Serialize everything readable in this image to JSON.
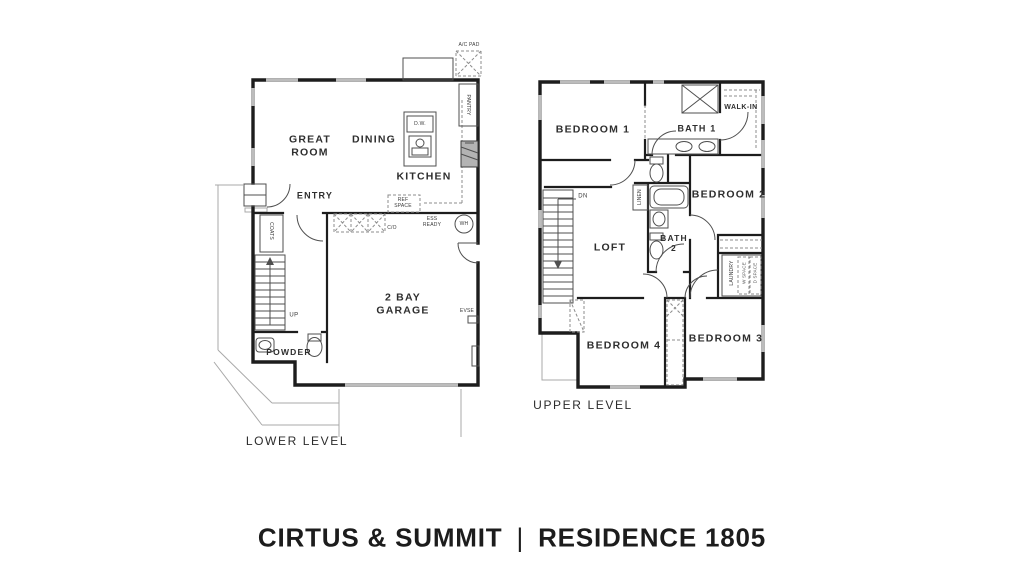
{
  "title": {
    "left": "CIRTUS & SUMMIT",
    "divider": "|",
    "right": "RESIDENCE 1805"
  },
  "lower": {
    "level_label": "LOWER LEVEL",
    "great_room": "GREAT ROOM",
    "dining": "DINING",
    "kitchen": "KITCHEN",
    "entry": "ENTRY",
    "garage": "2 BAY GARAGE",
    "powder": "POWDER",
    "up": "UP",
    "coats": "COATS",
    "pantry": "PANTRY",
    "dw": "D.W.",
    "ref_space": "REF SPACE",
    "ess_ready": "ESS READY",
    "co": "C/O",
    "wh": "WH",
    "evse": "EVSE",
    "ac_pad": "A/C PAD"
  },
  "upper": {
    "level_label": "UPPER LEVEL",
    "bedroom1": "BEDROOM 1",
    "bath1": "BATH 1",
    "walk_in": "WALK-IN",
    "bedroom2": "BEDROOM 2",
    "loft": "LOFT",
    "bath2": "BATH 2",
    "linen": "LINEN",
    "laundry": "LAUNDRY",
    "w_space": "W SPACE",
    "d_space": "D SPACE",
    "dn": "DN",
    "bedroom4": "BEDROOM 4",
    "bedroom3": "BEDROOM 3"
  },
  "colors": {
    "wall": "#1d1d1d",
    "thin": "#4f4f4f",
    "site": "#a9a9a9",
    "window": "#bcbcbc",
    "text": "#2e2e2e"
  }
}
